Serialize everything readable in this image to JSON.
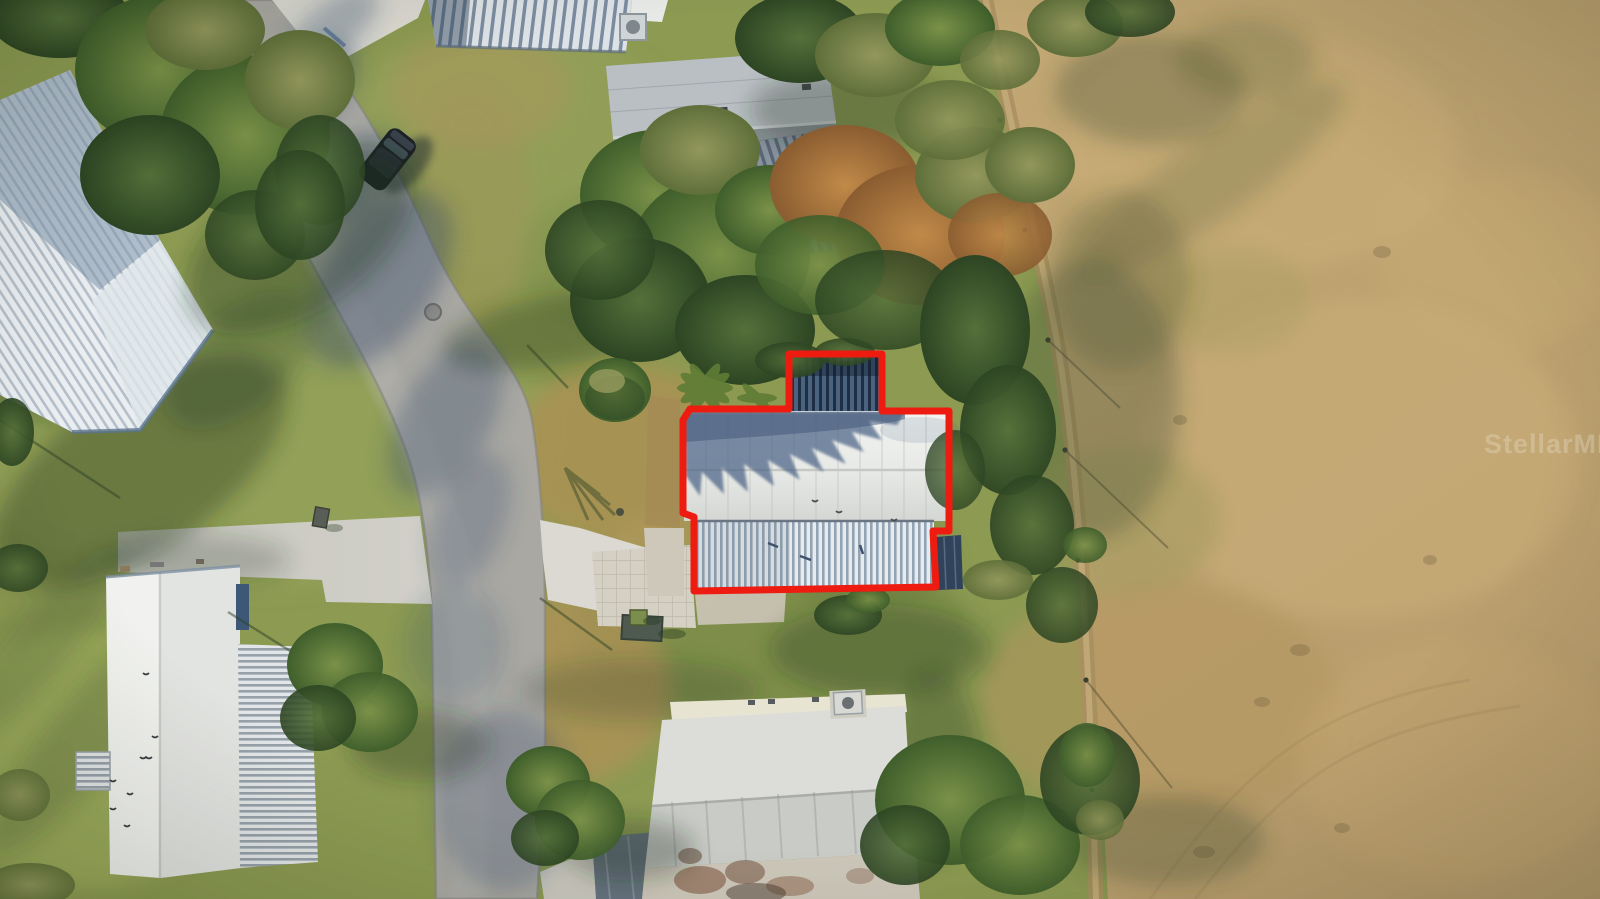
{
  "image": {
    "type": "aerial-drone-photo",
    "alt": "Aerial drone view of a mobile-home neighborhood: a curved gray street on the left, white metal-roof homes, dense green and orange trees, an open tan field on the right, and the subject home with carport outlined in red in the center."
  },
  "watermark": {
    "text": "StellarMLS",
    "color": "#ffffff",
    "opacity": "0.22"
  },
  "outline": {
    "color": "#ee1b10",
    "width": "7"
  },
  "palette": {
    "grass_base": "#8c9a52",
    "field": "#bfa471",
    "road": "#a9a8a2",
    "concrete": "#cfcdc4",
    "concrete_bright": "#dbd9d1",
    "roof_white": "#eceeeb",
    "roof_pale_corrugated": "#e7ebee",
    "carport_dark": "#4a647f",
    "shingle_gray": "#9aa2a7",
    "tree_green": "#4c6a33",
    "tree_orange": "#b07c3f",
    "shadow_green": "#243820",
    "shadow_blue": "#32486b",
    "car_body": "#1d2226"
  }
}
